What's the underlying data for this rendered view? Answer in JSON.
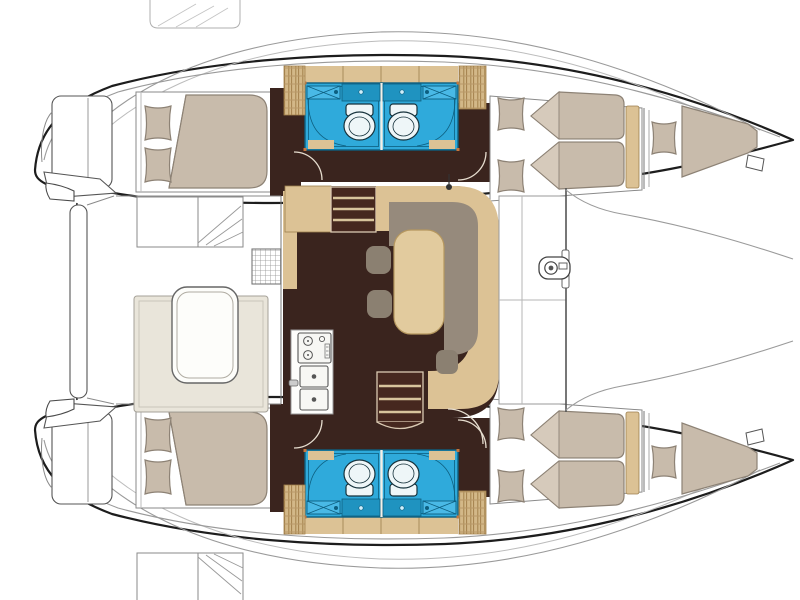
{
  "meta": {
    "description": "Top-down accommodation floor plan of a sailing catamaran",
    "view": "overhead deck plan",
    "bow_direction": "right",
    "stern_direction": "left",
    "text_on_image": ""
  },
  "layout_counts": {
    "sleeping_cabins": 4,
    "bathrooms": 4,
    "bow_berths": 2,
    "salon_tables": 1,
    "cockpit_tables": 1
  },
  "areas": {
    "cockpit": {
      "name": "aft cockpit",
      "features": [
        "u-shaped bench seat",
        "cockpit table",
        "boarding steps port",
        "boarding steps starboard",
        "deck grate",
        "sliding door to salon"
      ]
    },
    "salon": {
      "name": "salon and galley",
      "features": [
        "l-shaped sofa",
        "dining table",
        "two stools beside table",
        "one stool aft of table",
        "galley counter",
        "stove with burners",
        "double sink with faucet",
        "companionway steps to port hull",
        "companionway steps to starboard hull",
        "support post",
        "sideboard",
        "cabinet"
      ]
    },
    "port_hull": {
      "name": "port hull (top)",
      "features": [
        "aft double berth with two pillows",
        "duvet fold",
        "two bathrooms back to back",
        "toilet x2",
        "washbasin x2",
        "vanity counter x2",
        "shower curtain curves",
        "slatted lockers",
        "forward double berth with two pillows",
        "headboard panel",
        "bow single berth with pillow",
        "bow mooring cleat",
        "transom swim platform",
        "door swing arcs"
      ]
    },
    "starboard_hull": {
      "name": "starboard hull (bottom)",
      "features": [
        "aft double berth with two pillows",
        "duvet fold",
        "two bathrooms back to back",
        "toilet x2",
        "washbasin x2",
        "vanity counter x2",
        "shower curtain curves",
        "slatted lockers",
        "forward double berth with two pillows",
        "headboard panel",
        "bow single berth with pillow",
        "bow mooring cleat",
        "transom swim platform",
        "door swing arcs"
      ]
    },
    "foredeck": {
      "name": "foredeck",
      "features": [
        "forward crossbeam",
        "anchor windlass",
        "trampoline area",
        "deck locker hatches"
      ]
    },
    "stern": {
      "name": "stern platform",
      "features": [
        "aft crossdeck platform",
        "davit bracket port",
        "davit bracket starboard",
        "transom steps"
      ]
    }
  },
  "colors": {
    "floor": "#3A241E",
    "floor_steps": "#46281F",
    "wood": "#DCC295",
    "wood_line": "#9C7F4E",
    "locker": "#D3B888",
    "locker_line": "#A3814C",
    "mattress": "#C8BBAB",
    "mattress_line": "#8D8275",
    "mattress_flap": "#D6CABB",
    "cushion": "#968A7C",
    "stool": "#8B8071",
    "table": "#E2CB9E",
    "table_edge": "#B5975F",
    "bench": "#E9E5DA",
    "bath": "#2FAADB",
    "bath_mid": "#1F93C0",
    "bath_hi": "#49B9E6",
    "bath_line": "#0D5F80",
    "fixture": "#EEF6F8",
    "fixture_line": "#16323C",
    "hull_line": "#1D1D1D",
    "door_arc": "#E6DDCF",
    "accent_dot": "#C7763E"
  }
}
